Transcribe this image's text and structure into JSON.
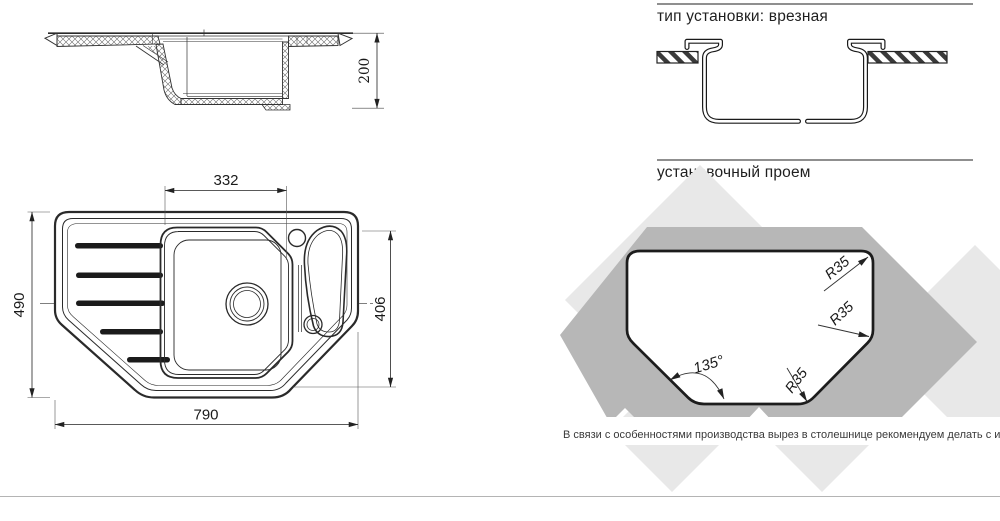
{
  "side_view": {
    "depth_label": "200"
  },
  "top_view": {
    "bowl_width_label": "332",
    "overall_depth_label": "490",
    "right_depth_label": "406",
    "overall_width_label": "790"
  },
  "installation_section": {
    "title": "тип установки: врезная"
  },
  "cutout_section": {
    "title": "установочный проем",
    "radius_top": "R35",
    "radius_right": "R35",
    "radius_bottom": "R35",
    "angle": "135°"
  },
  "footnote": "В связи с особенностями производства вырез в столешнице рекомендуем делать с изделия.",
  "colors": {
    "line": "#2a2a2a",
    "watermark_light": "#e8e8e8",
    "watermark_dark": "#b7b7b7",
    "rule": "#8f8f8f"
  }
}
